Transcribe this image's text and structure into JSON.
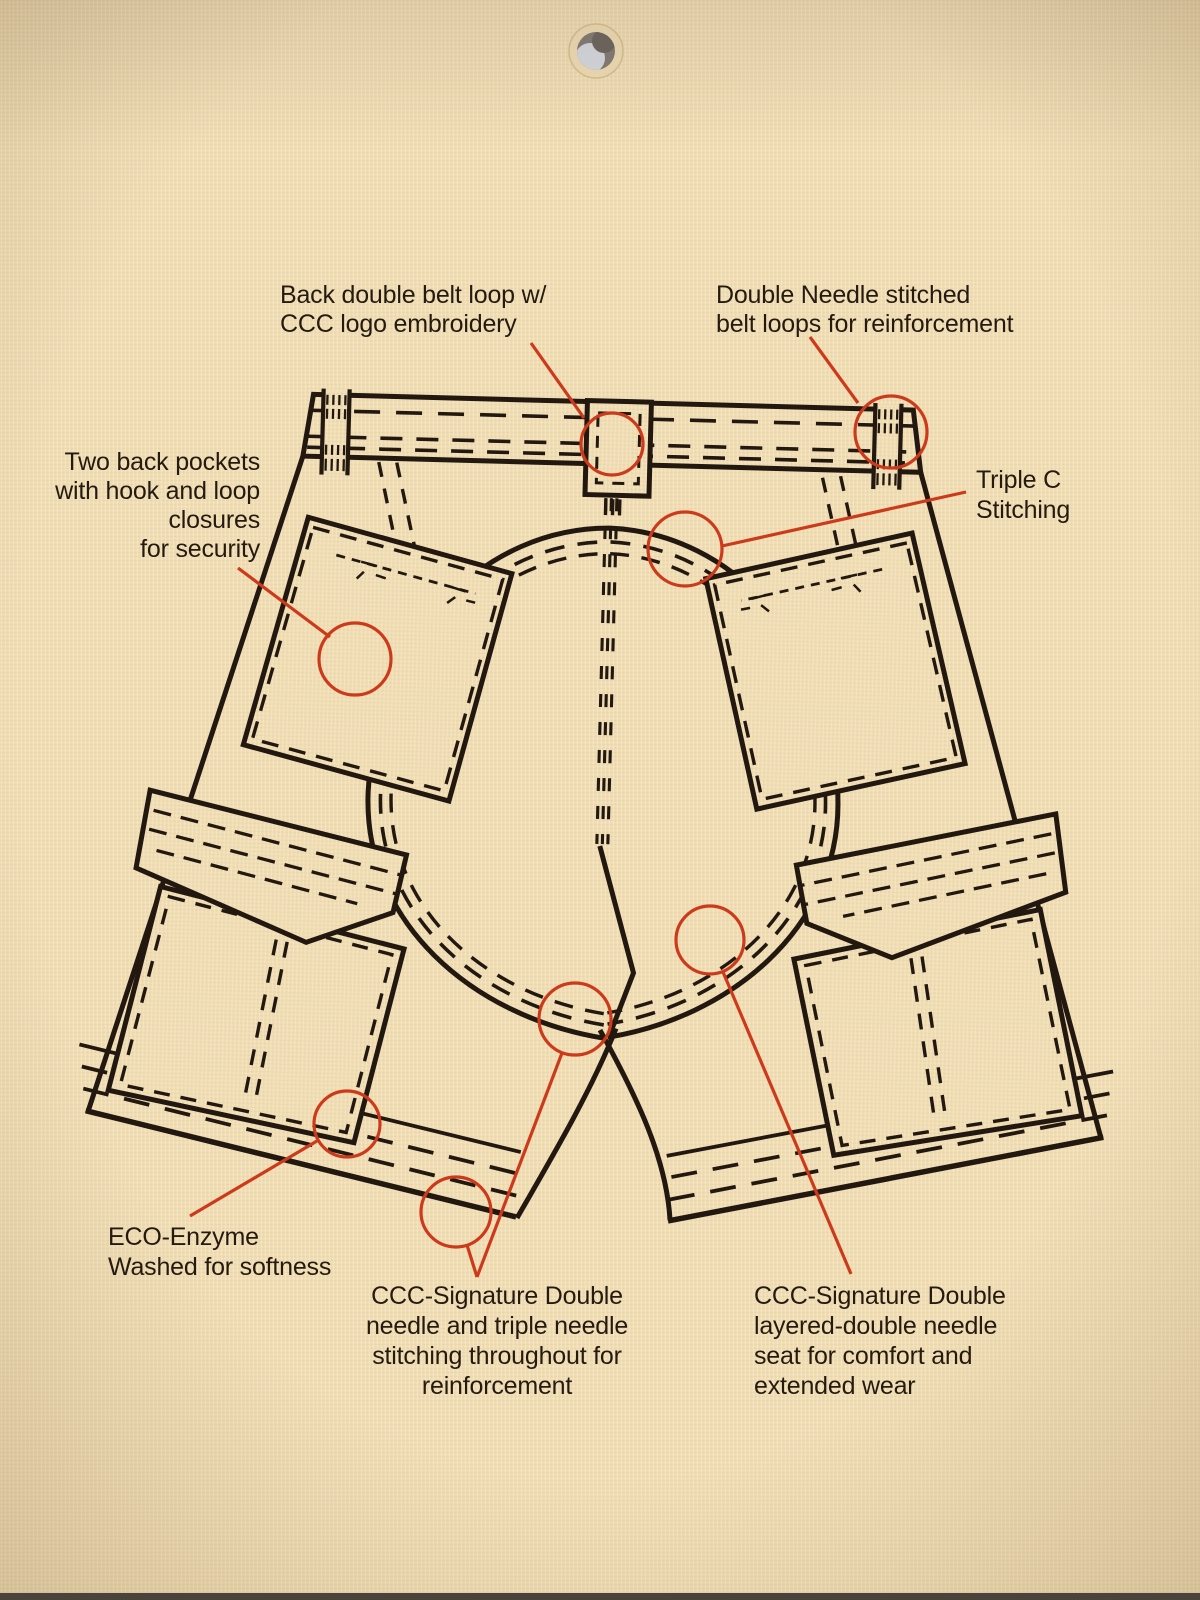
{
  "colors": {
    "paper": "#f0ddb4",
    "ink": "#221810",
    "accent": "#cc3a1b",
    "text": "#241a10"
  },
  "tag": {
    "type": "product hang tag",
    "subject": "cargo shorts back view technical line drawing",
    "hole_punch_icon": "punched-hole-icon"
  },
  "callouts": [
    {
      "id": "back-belt-loop",
      "lines": [
        "Back double belt loop w/",
        "CCC logo embroidery"
      ]
    },
    {
      "id": "double-needle-belt-loops",
      "lines": [
        "Double Needle stitched",
        "belt loops for reinforcement"
      ]
    },
    {
      "id": "back-pockets",
      "lines": [
        "Two back pockets",
        "with hook and loop",
        "closures",
        "for security"
      ]
    },
    {
      "id": "triple-c-stitching",
      "lines": [
        "Triple C",
        "Stitching"
      ]
    },
    {
      "id": "eco-enzyme",
      "lines": [
        "ECO-Enzyme",
        "Washed for softness"
      ]
    },
    {
      "id": "signature-stitching",
      "lines": [
        "CCC-Signature Double",
        "needle and triple needle",
        "stitching throughout for",
        "reinforcement"
      ]
    },
    {
      "id": "signature-seat",
      "lines": [
        "CCC-Signature Double",
        "layered-double needle",
        "seat for comfort and",
        "extended wear"
      ]
    }
  ]
}
